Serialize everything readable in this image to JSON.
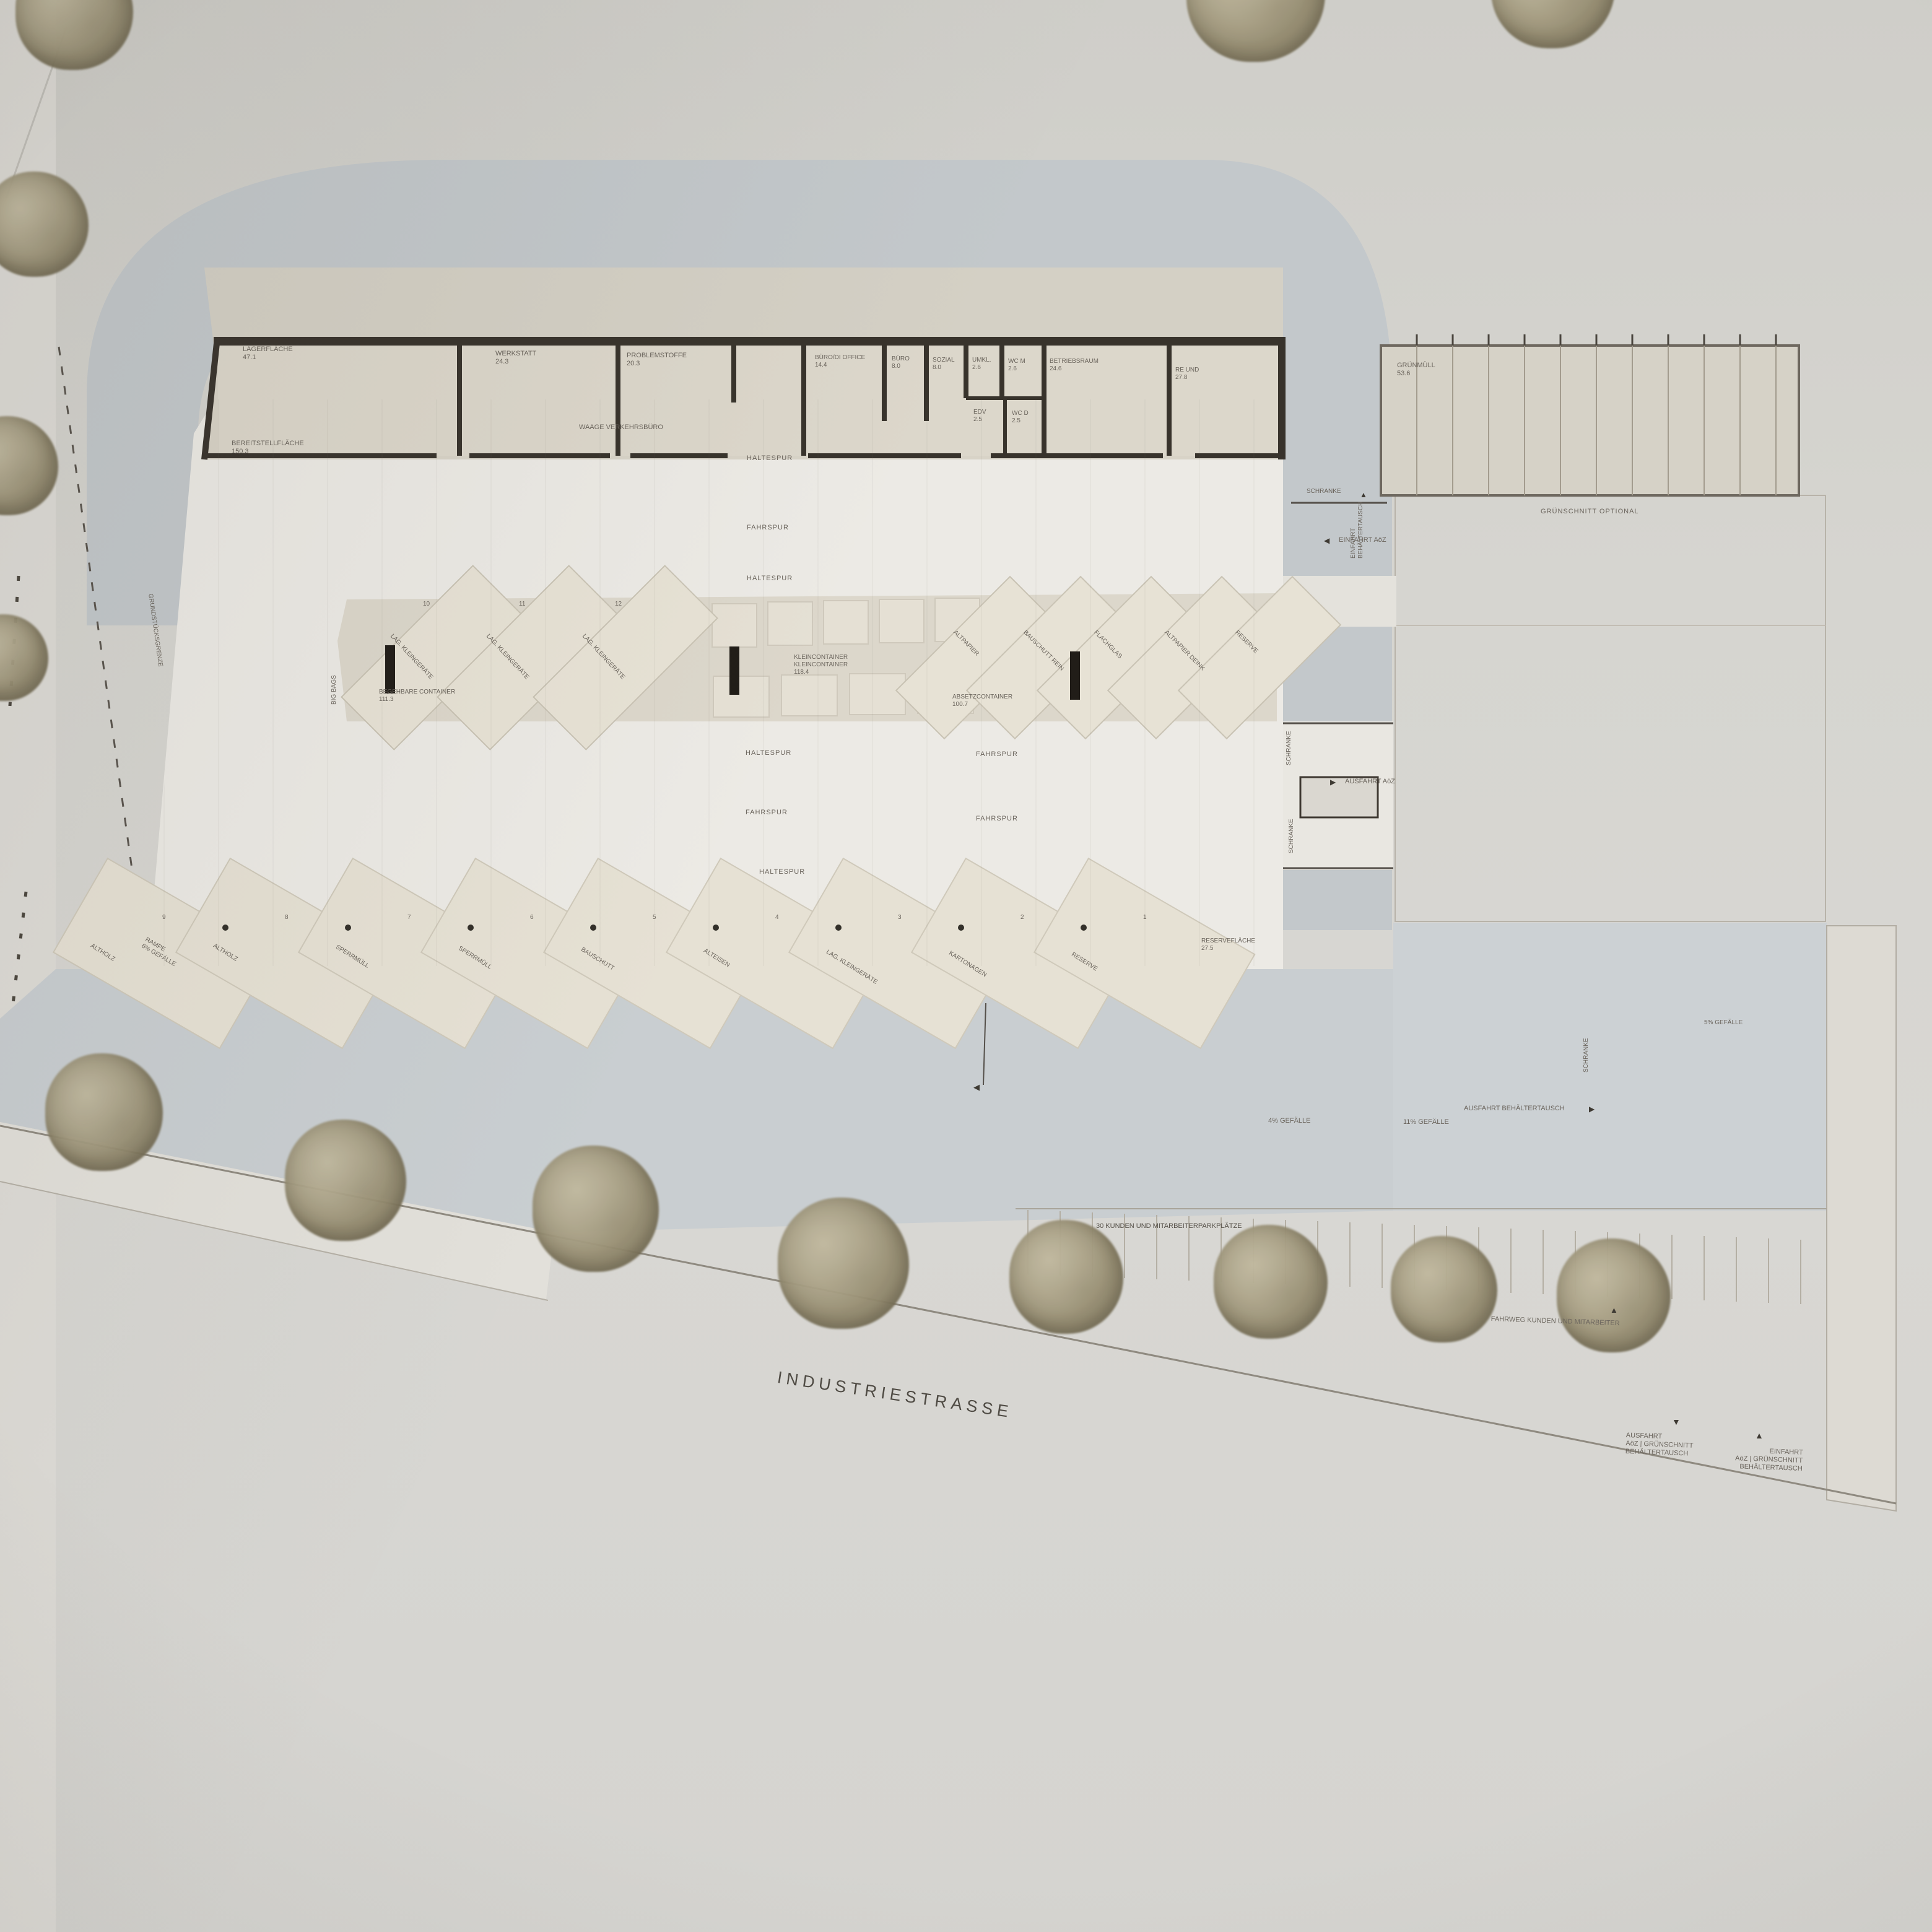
{
  "plan": {
    "street_label": "INDUSTRIESTRASSE",
    "boundary_label": "GRUNDSTÜCKSGRENZE",
    "big_bags_label": "BIG BAGS",
    "ramp": {
      "line1": "RAMPE",
      "line2": "6% GEFÄLLE"
    }
  },
  "building": {
    "rooms": [
      {
        "name": "LAGERFLÄCHE",
        "area": "47.1"
      },
      {
        "name": "WERKSTATT",
        "area": "24.3"
      },
      {
        "name": "PROBLEMSTOFFE",
        "area": "20.3"
      },
      {
        "name": "BÜRO/DI OFFICE",
        "area": "14.4"
      },
      {
        "name": "BÜRO",
        "area": "8.0"
      },
      {
        "name": "SOZIAL",
        "area": "8.0"
      },
      {
        "name": "UMKL.",
        "area": "2.6"
      },
      {
        "name": "WC M",
        "area": "2.6"
      },
      {
        "name": "EDV",
        "area": "2.5"
      },
      {
        "name": "WC D",
        "area": "2.5"
      },
      {
        "name": "BETRIEBSRAUM",
        "area": "24.6"
      },
      {
        "name": "RE UND",
        "area": "27.8"
      }
    ],
    "hall_label": "WAAGE VERKEHRSBÜRO",
    "apron_label": {
      "name": "BEREITSTELLFLÄCHE",
      "area": "150.3"
    },
    "annex": {
      "name": "GRÜNMÜLL",
      "area": "53.6"
    }
  },
  "lanes": {
    "l1": "HALTESPUR",
    "l2": "FAHRSPUR",
    "l3": "HALTESPUR",
    "l4": "HALTESPUR",
    "l5": "FAHRSPUR",
    "l6": "HALTESPUR",
    "r1": "FAHRSPUR",
    "r2": "FAHRSPUR"
  },
  "island": {
    "left_bays": [
      {
        "num": "10",
        "label": "LAG. KLEINGERÄTE"
      },
      {
        "num": "11",
        "label": "LAG. KLEINGERÄTE"
      },
      {
        "num": "12",
        "label": "LAG. KLEINGERÄTE"
      }
    ],
    "right_bays": [
      "ALTPAPIER",
      "BAUSCHUTT REIN",
      "FLACHGLAS",
      "ALTPAPIER DEINK",
      "RESERVE"
    ],
    "center_label": {
      "line1": "KLEINCONTAINER",
      "line2": "KLEINCONTAINER",
      "area": "118.4"
    },
    "absetz": {
      "name": "ABSETZCONTAINER",
      "area": "100.7"
    },
    "begehbar": {
      "name": "BEGEHBARE CONTAINER",
      "area": "111.3"
    }
  },
  "bottom_bays": [
    {
      "num": "9",
      "label": "ALTHOLZ"
    },
    {
      "num": "8",
      "label": "ALTHOLZ"
    },
    {
      "num": "7",
      "label": "SPERRMÜLL"
    },
    {
      "num": "6",
      "label": "SPERRMÜLL"
    },
    {
      "num": "5",
      "label": "BAUSCHUTT"
    },
    {
      "num": "4",
      "label": "ALTEISEN"
    },
    {
      "num": "3",
      "label": "LAG. KLEINGERÄTE"
    },
    {
      "num": "2",
      "label": "KARTONAGEN"
    },
    {
      "num": "1",
      "label": "RESERVE"
    }
  ],
  "reserve_area": {
    "name": "RESERVEFLÄCHE",
    "area": "27.5"
  },
  "annotations": {
    "einfahrt_behaeltertausch_1": "EINFAHRT",
    "einfahrt_behaeltertausch_2": "BEHÄLTERTAUSCH",
    "schranke": "SCHRANKE",
    "einfahrt_aoz": "EINFAHRT AöZ",
    "gruenschnitt_optional": "GRÜNSCHNITT OPTIONAL",
    "ausfahrt_aoz": "AUSFAHRT AöZ",
    "gefaelle_4": "4% GEFÄLLE",
    "gefaelle_11": "11% GEFÄLLE",
    "gefaelle_5": "5% GEFÄLLE",
    "ausfahrt_behaeltertausch": "AUSFAHRT BEHÄLTERTAUSCH",
    "parking_label": "30 KUNDEN UND MITARBEITERPARKPLÄTZE",
    "fahrweg_label": "FAHRWEG KUNDEN UND MITARBEITER",
    "corner_out": {
      "l1": "AUSFAHRT",
      "l2": "AöZ | GRÜNSCHNITT",
      "l3": "BEHÄLTERTAUSCH"
    },
    "corner_in": {
      "l1": "EINFAHRT",
      "l2": "AöZ | GRÜNSCHNITT",
      "l3": "BEHÄLTERTAUSCH"
    }
  },
  "icons": {
    "left": "◀",
    "right": "▶",
    "up": "▲",
    "down": "▼"
  },
  "colors": {
    "paper": "#d6d5d0",
    "road": "#c3c8cb",
    "yard": "#eceae5",
    "building": "#d7d2c6",
    "wall": "#38332c",
    "island": "#dcd7cb",
    "bay": "#e6e1d4",
    "apron": "#c9ced1",
    "text": "#6a645c",
    "tree": "#a89f84"
  }
}
